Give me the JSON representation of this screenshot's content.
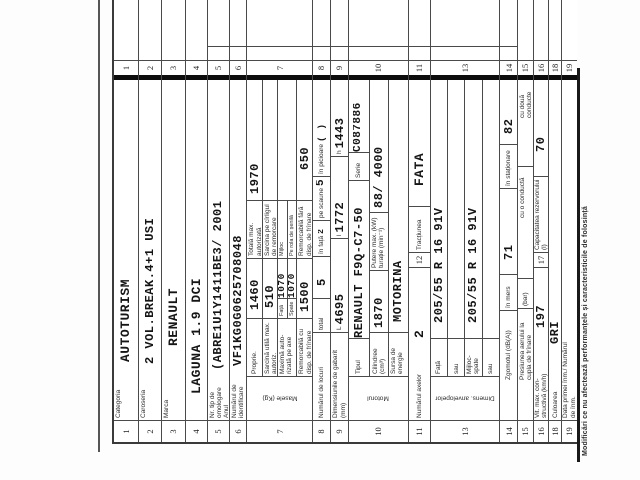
{
  "serial": "UI 535200",
  "category_mark": ">",
  "footer": "Modificări ce nu afectează performanțele și caracteristicile de folosință",
  "rows": {
    "r1": {
      "num": "1",
      "label": "Categoria",
      "value": "AUTOTURISM"
    },
    "r2": {
      "num": "2",
      "label": "Caroseria",
      "value": "2 VOL.BREAK.4+1 USI"
    },
    "r3": {
      "num": "3",
      "label": "Marca",
      "value": "RENAULT"
    },
    "r4": {
      "num": "4",
      "label": "",
      "value": "LAGUNA 1.9 DCI"
    },
    "r5": {
      "num": "5",
      "label": "Nr. tip de omologare Anul fabricației",
      "value": "(ABRE1U1Y1411BE3/ 2001"
    },
    "r6": {
      "num": "6",
      "label": "Numărul de identificare",
      "value": "VF1KG0G0625708048"
    },
    "r7": {
      "num": "7",
      "side_label": "Masele (Kg)",
      "proprie_label": "Proprie.",
      "proprie": "1460",
      "totala_label": "Totală max. autorizată",
      "totala": "1970",
      "sarcina_utila_label": "Sarcină utilă max. autoriz.",
      "sarcina_utila": "510",
      "sarcina_carlig_label": "Sarcina pe cîrligul de remorcare",
      "sarcina_carlig": "",
      "maxima_axe_label": "Maximă auto- rizată pe axe",
      "fata_label": "Față",
      "fata": "1070",
      "spate_label": "Spate",
      "spate": "1070",
      "mijloc_label": "Mijloc",
      "rola_label": "Pe rola de șenilă",
      "remorc_cu_label": "Remorcabilă cu disp. de frînare",
      "remorc_cu": "1500",
      "remorc_fara_label": "Remorcabilă fără disp. de frînare",
      "remorc_fara": "650"
    },
    "r8": {
      "num": "8",
      "label": "Numărul de locuri",
      "total_label": "total",
      "total": "5",
      "fata_label": "în față",
      "fata": "2",
      "scaune_label": "pe scaune",
      "scaune": "5",
      "picioare_label": "în picioare",
      "picioare": "( )"
    },
    "r9": {
      "num": "9",
      "label": "Dimensiunile de gabarit (mm)",
      "L_label": "L",
      "L": "4695",
      "l_label": "l",
      "l": "1772",
      "h_label": "h",
      "h": "1443"
    },
    "r10": {
      "num": "10",
      "side_label": "Motorul",
      "tip_label": "Tipul",
      "tip": "RENAULT F9Q-C7-50",
      "serie_label": "Serie",
      "serie": "C087886",
      "cilindree_label": "Cilindree (cm³)",
      "cilindree": "1870",
      "putere_label": "Putere max. (kW) turație (min⁻¹)",
      "putere": "88/ 4000",
      "sursa_label": "Sursa de energie",
      "sursa": "MOTORINA"
    },
    "r11": {
      "num": "11",
      "label": "Numărul axelor",
      "value": "2"
    },
    "r12": {
      "num": "12",
      "label": "Tracțiunea",
      "value": "FATA"
    },
    "r13": {
      "num": "13",
      "side_label": "Dimens. anvelopelor",
      "fata_label": "Față",
      "fata": "205/55 R 16 91V",
      "sau1_label": "sau",
      "sau1": "",
      "mijloc_label": "Mijloc- spate",
      "mijloc": "205/55 R 16 91V",
      "sau2_label": "sau",
      "sau2": ""
    },
    "r14": {
      "num": "14",
      "label": "Zgomotul (dB(A))",
      "mers_label": "în mers",
      "mers": "71",
      "stationare_label": "în staționare",
      "stationare": "82"
    },
    "r15": {
      "num": "15",
      "label": "Presiunea aerului la cupla de frînare",
      "bar_label": "(bar)",
      "c1_label": "cu o conductă",
      "c2_label": "cu două conducte"
    },
    "r16": {
      "num": "16",
      "label": "Vit. max. con- structivă (km/h)",
      "value": "197"
    },
    "r17": {
      "num": "17",
      "label": "Capacitatea rezervorului (l)",
      "value": "70"
    },
    "r18": {
      "num": "18",
      "label": "Culoarea",
      "value": "GRI"
    },
    "r19": {
      "num": "19",
      "label": "Data primei înm./ Numărul de înm.",
      "value": ""
    }
  }
}
